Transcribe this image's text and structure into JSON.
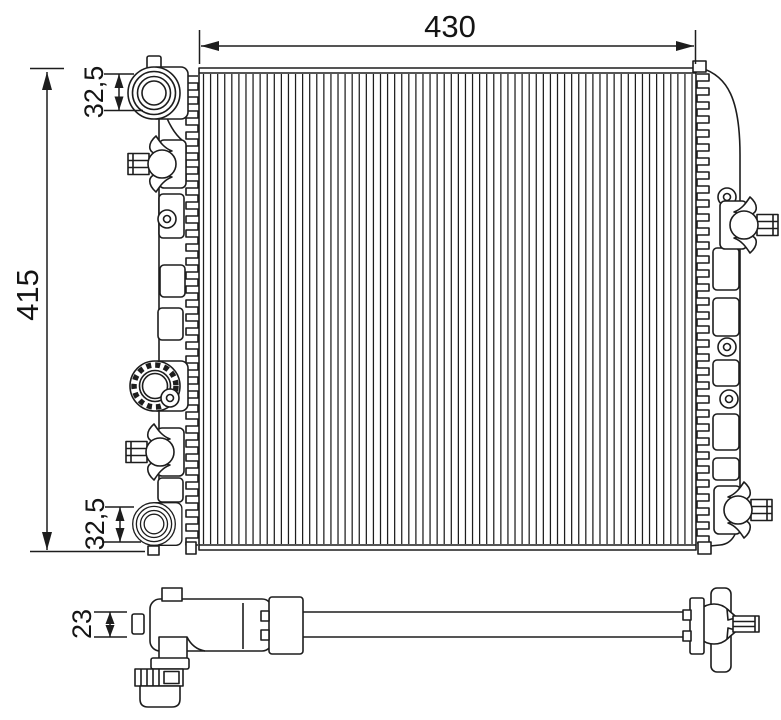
{
  "drawing": {
    "background": "#ffffff",
    "line_color": "#1d1d1d",
    "dimensions": {
      "overall_width": "430",
      "overall_height": "415",
      "port_top": "32,5",
      "port_bottom": "32,5",
      "depth": "23"
    }
  }
}
